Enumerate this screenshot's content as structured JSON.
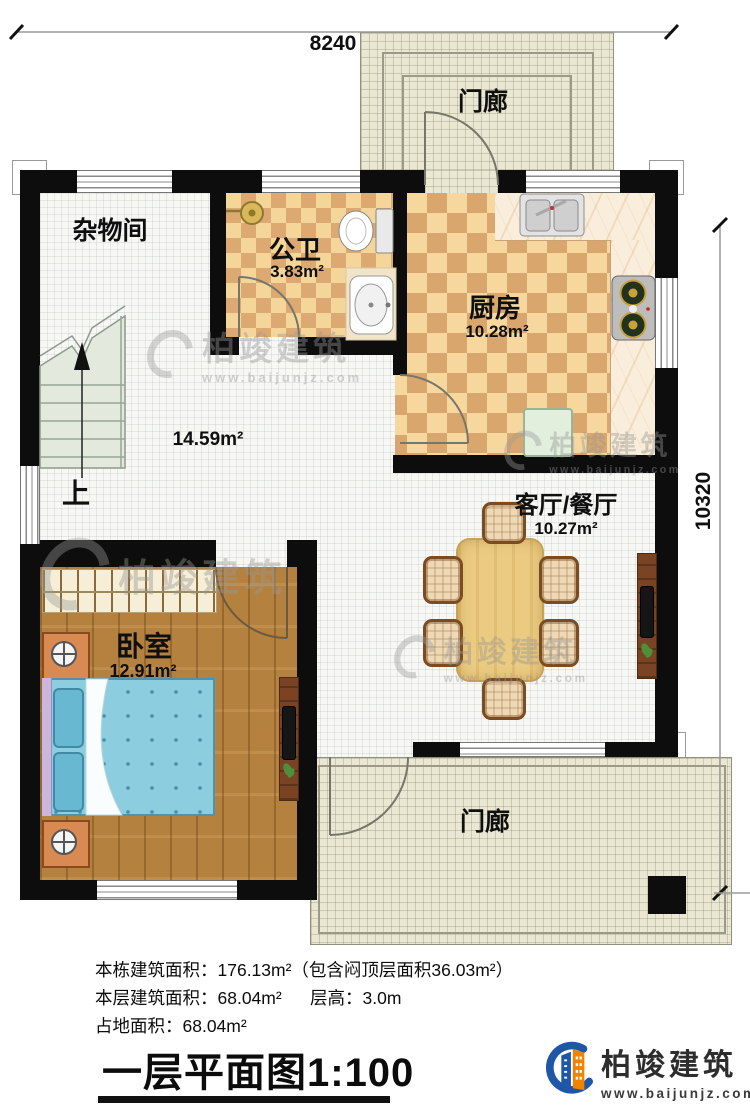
{
  "plan": {
    "dimensions": {
      "top": "8240",
      "right": "10320"
    },
    "rooms": {
      "porch_top": {
        "label": "门廊"
      },
      "storage": {
        "label": "杂物间"
      },
      "bathroom": {
        "label": "公卫",
        "area": "3.83m²"
      },
      "kitchen": {
        "label": "厨房",
        "area": "10.28m²"
      },
      "hall": {
        "area": "14.59m²"
      },
      "living_dining": {
        "label": "客厅/餐厅",
        "area": "10.27m²"
      },
      "bedroom": {
        "label": "卧室",
        "area": "12.91m²"
      },
      "porch_bottom": {
        "label": "门廊"
      },
      "stairs": {
        "direction_label": "上"
      }
    }
  },
  "info": {
    "total_area_line": "本栋建筑面积：176.13m²（包含闷顶层面积36.03m²）",
    "floor_area_line": "本层建筑面积：68.04m²",
    "floor_height_line": "层高：3.0m",
    "footprint_line": "占地面积：68.04m²",
    "title": "一层平面图1:100"
  },
  "branding": {
    "company": "柏竣建筑",
    "website": "www.baijunjz.com"
  },
  "watermark": {
    "company": "柏竣建筑",
    "website": "www.baijunjz.com"
  },
  "colors": {
    "wall": "#0d0d0d",
    "checker_dark": "#d9a76d",
    "checker_light": "#f6d89e",
    "wood": "#b5813f",
    "bed": "#8ccddf",
    "porch": "#eae8d2",
    "brand_blue": "#1e56a8",
    "brand_orange": "#f08300"
  }
}
